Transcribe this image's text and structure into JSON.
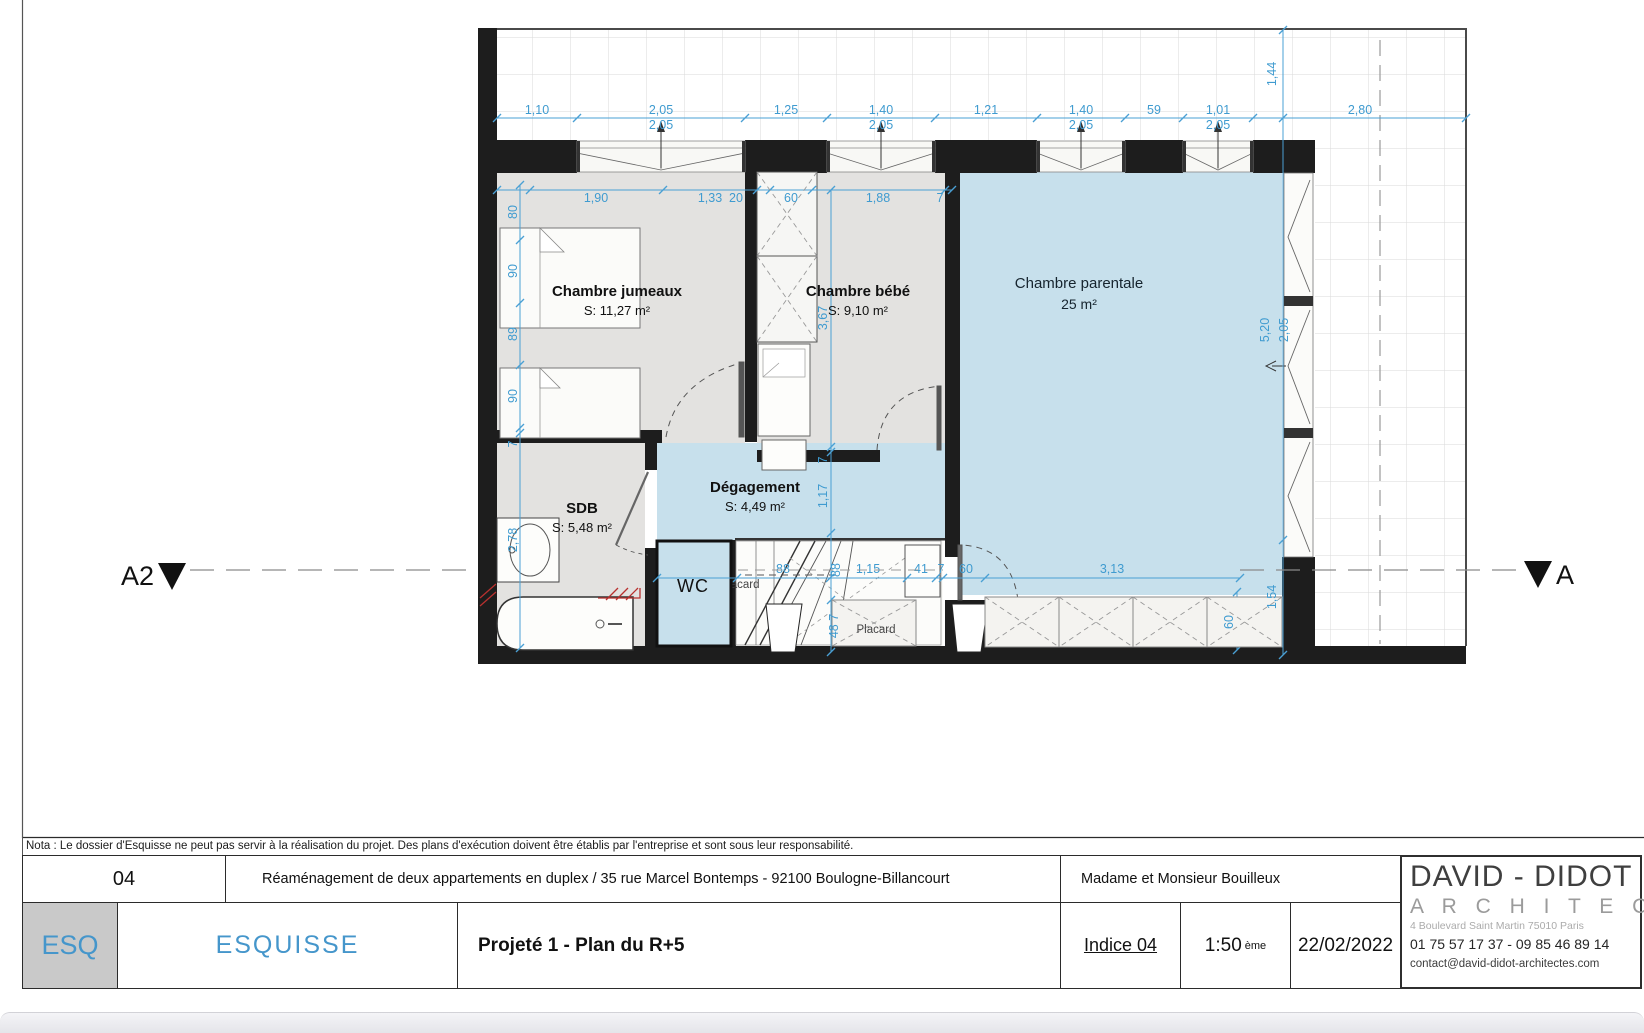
{
  "plan": {
    "rooms": [
      {
        "name": "Chambre jumeaux",
        "area": "S: 11,27 m²"
      },
      {
        "name": "Chambre bébé",
        "area": "S: 9,10 m²"
      },
      {
        "name": "Chambre parentale",
        "area": "25 m²"
      },
      {
        "name": "SDB",
        "area": "S: 5,48 m²"
      },
      {
        "name": "Dégagement",
        "area": "S: 4,49 m²"
      },
      {
        "name": "WC"
      },
      {
        "name": "Placard"
      }
    ],
    "section_markers": {
      "left": "A2",
      "right": "A"
    },
    "dims": {
      "top": [
        {
          "v": "1,10"
        },
        {
          "v": "2,05",
          "sub": "2,05"
        },
        {
          "v": "1,25"
        },
        {
          "v": "1,40",
          "sub": "2,05"
        },
        {
          "v": "1,21"
        },
        {
          "v": "1,40",
          "sub": "2,05"
        },
        {
          "v": "59"
        },
        {
          "v": "1,01",
          "sub": "2,05"
        },
        {
          "v": "2,80"
        }
      ],
      "inner_top": [
        "1,90",
        "1,33",
        "20",
        "60",
        "1,88",
        "7"
      ],
      "left": [
        "80",
        "90",
        "89",
        "90",
        "7",
        "2,78"
      ],
      "center": [
        "3,67",
        "7",
        "1,17",
        "88",
        "48 7"
      ],
      "bottom": [
        "88",
        "1,15",
        "41",
        "7",
        "60",
        "3,13"
      ],
      "right": [
        "1,44",
        "5,20",
        "2,05",
        "1,54"
      ],
      "wardrobe_depth": "60"
    }
  },
  "nota": "Nota : Le dossier d'Esquisse ne peut pas servir à la réalisation du projet. Des plans d'exécution doivent être établis par l'entreprise et sont sous leur responsabilité.",
  "title_block": {
    "sheet_number": "04",
    "project": "Réaménagement de deux appartements en duplex / 35 rue Marcel Bontemps - 92100 Boulogne-Billancourt",
    "client": "Madame et Monsieur Bouilleux",
    "phase_code": "ESQ",
    "phase_label": "ESQUISSE",
    "drawing_title": "Projeté 1 - Plan du R+5",
    "indice": "Indice 04",
    "scale": "1:50",
    "scale_sup": "ème",
    "date": "22/02/2022"
  },
  "firm": {
    "name": "DAVID - DIDOT",
    "subtitle": "A R C H I T E C T E S",
    "address": "4 Boulevard Saint Martin 75010 Paris",
    "phones": "01 75 57 17 37 - 09 85 46 89 14",
    "email": "contact@david-didot-architectes.com"
  },
  "colors": {
    "wall": "#1d1d1d",
    "room_gray": "#e3e2e0",
    "room_blue": "#c7e0ec",
    "dimension_blue": "#3f9bd0",
    "accent_blue": "#4596cb",
    "demolition_red": "#b8312f"
  }
}
